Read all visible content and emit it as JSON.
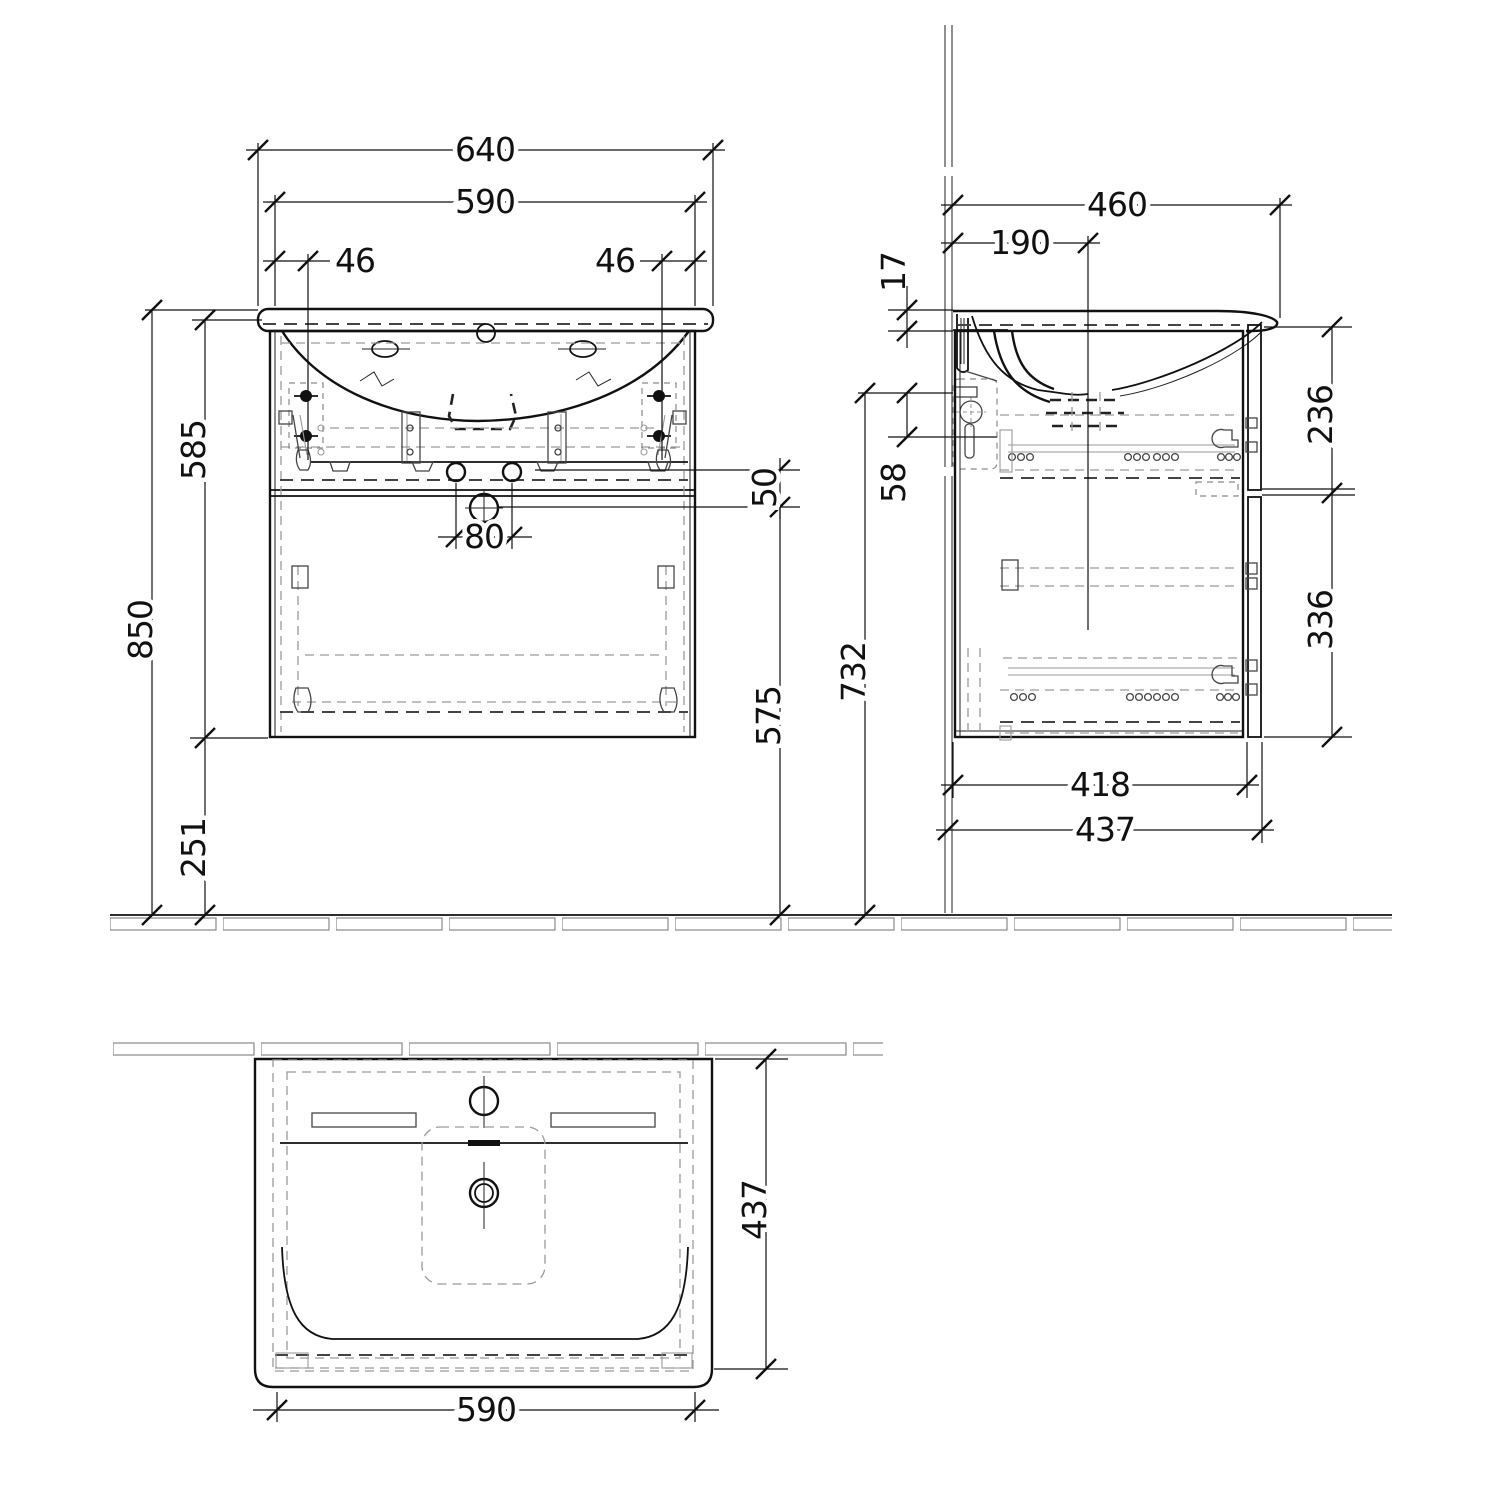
{
  "front_view": {
    "overall_width": "640",
    "cabinet_width": "590",
    "left_offset": "46",
    "right_offset": "46",
    "overall_height": "850",
    "cabinet_height": "585",
    "bottom_clearance": "251",
    "hole_spacing": "80",
    "rail_offset": "50",
    "outlet_height": "575",
    "mounting_height": "732"
  },
  "side_view": {
    "overall_depth": "460",
    "tap_center_distance": "190",
    "basin_thickness": "17",
    "bracket_offset": "58",
    "upper_front_height": "236",
    "lower_front_height": "336",
    "cabinet_depth": "418",
    "front_depth": "437"
  },
  "plan_view": {
    "basin_width": "590",
    "basin_depth": "437"
  }
}
